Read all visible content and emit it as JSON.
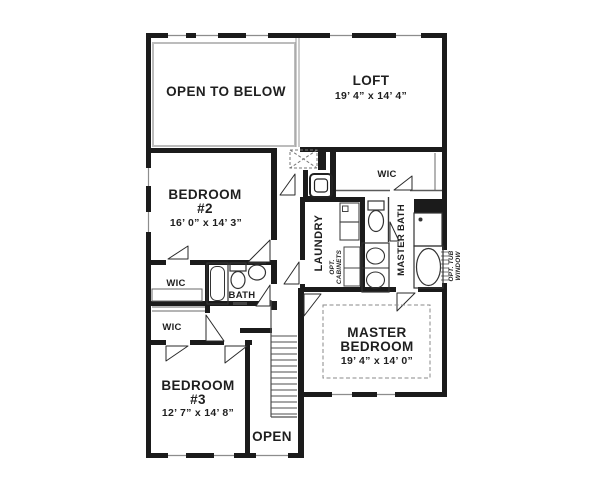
{
  "plan_title": "second floor plan",
  "colors": {
    "wall": "#1b1b1b",
    "thin_line": "#5a5a5a",
    "rail": "#bcbcbc",
    "dash": "#8a8a8a",
    "text": "#1f1f1f"
  },
  "rooms": {
    "open_to_below": {
      "name": "OPEN TO BELOW"
    },
    "loft": {
      "name": "LOFT",
      "dims": "19’ 4” x 14’ 4”"
    },
    "bedroom2": {
      "name": "BEDROOM",
      "number": "#2",
      "dims": "16’ 0” x 14’ 3”"
    },
    "wic_hall": {
      "name": "WIC"
    },
    "bath": {
      "name": "BATH"
    },
    "wic_lower": {
      "name": "WIC"
    },
    "bedroom3": {
      "name": "BEDROOM",
      "number": "#3",
      "dims": "12’ 7” x 14’ 8”"
    },
    "stairwell": {
      "name": "OPEN"
    },
    "laundry": {
      "name": "LAUNDRY",
      "opt_line1": "OPT.",
      "opt_line2": "CABINETS"
    },
    "master_wic": {
      "name": "WIC"
    },
    "master_bath": {
      "name": "MASTER BATH"
    },
    "tub_window_note": {
      "line1": "OPT. TUB",
      "line2": "WINDOW"
    },
    "master_bedroom": {
      "line1": "MASTER",
      "line2": "BEDROOM",
      "dims": "19’ 4” x 14’ 0”"
    }
  }
}
